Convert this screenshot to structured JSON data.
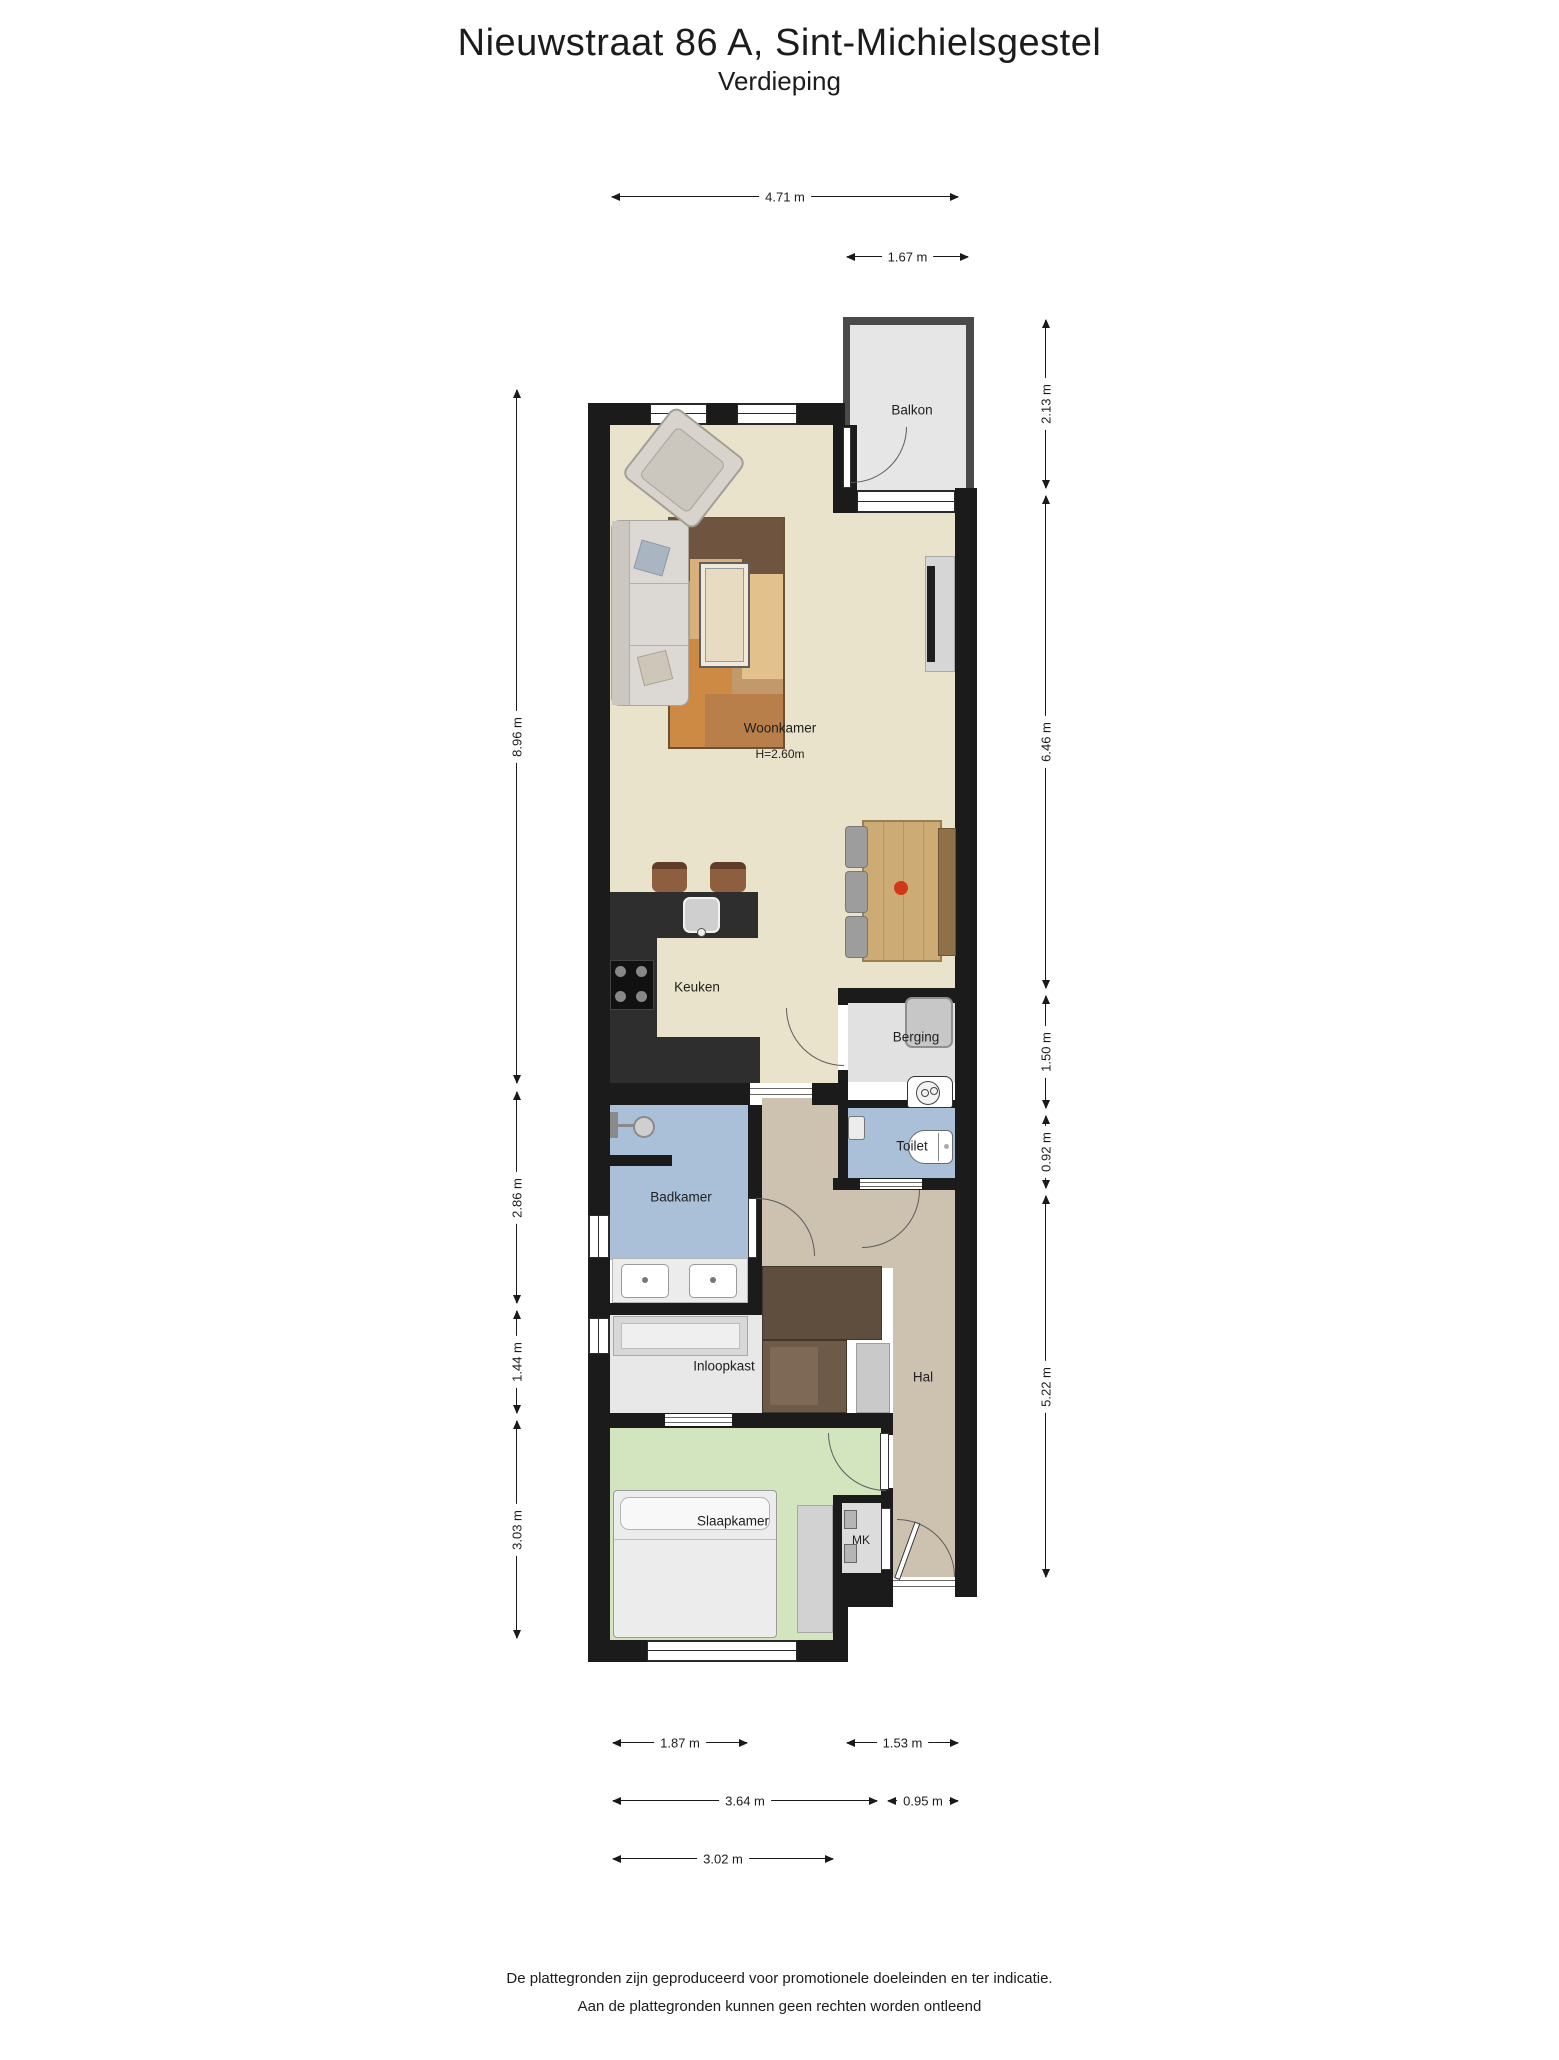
{
  "title": "Nieuwstraat 86 A, Sint-Michielsgestel",
  "subtitle": "Verdieping",
  "labels": {
    "balkon": "Balkon",
    "woonkamer": "Woonkamer",
    "woonkamer_height": "H=2.60m",
    "keuken": "Keuken",
    "berging": "Berging",
    "toilet": "Toilet",
    "badkamer": "Badkamer",
    "hal": "Hal",
    "inloopkast": "Inloopkast",
    "slaapkamer": "Slaapkamer",
    "mk": "MK"
  },
  "dims": {
    "top": {
      "d1": "4.71 m",
      "d2": "1.67 m"
    },
    "right": {
      "d1": "2.13 m",
      "d2": "6.46 m",
      "d3": "1.50 m",
      "d4": "0.92 m",
      "d5": "5.22 m"
    },
    "left": {
      "d1": "8.96 m",
      "d2": "2.86 m",
      "d3": "1.44 m",
      "d4": "3.03 m"
    },
    "bottom": {
      "d1": "1.87 m",
      "d2": "1.53 m",
      "d3": "3.64 m",
      "d4": "0.95 m",
      "d5": "3.02 m"
    }
  },
  "footer": {
    "line1": "De plattegronden zijn geproduceerd voor promotionele doeleinden en ter indicatie.",
    "line2": "Aan de plattegronden kunnen geen rechten worden ontleend"
  },
  "colors": {
    "wall": "#1b1b1b",
    "living_floor": "#eae3cb",
    "hall_floor": "#cdc2af",
    "bedroom_floor": "#d3e5bf",
    "bathroom_floor": "#a9c0d8",
    "storage_floor": "#e1e1e1",
    "balcony_floor": "#e6e6e6",
    "closet_floor": "#e8e8e8",
    "kitchen_counter": "#2e2e2e",
    "wardrobe": "#5f4d3e",
    "table_wood": "#cdab75",
    "accent_red": "#d03818"
  }
}
